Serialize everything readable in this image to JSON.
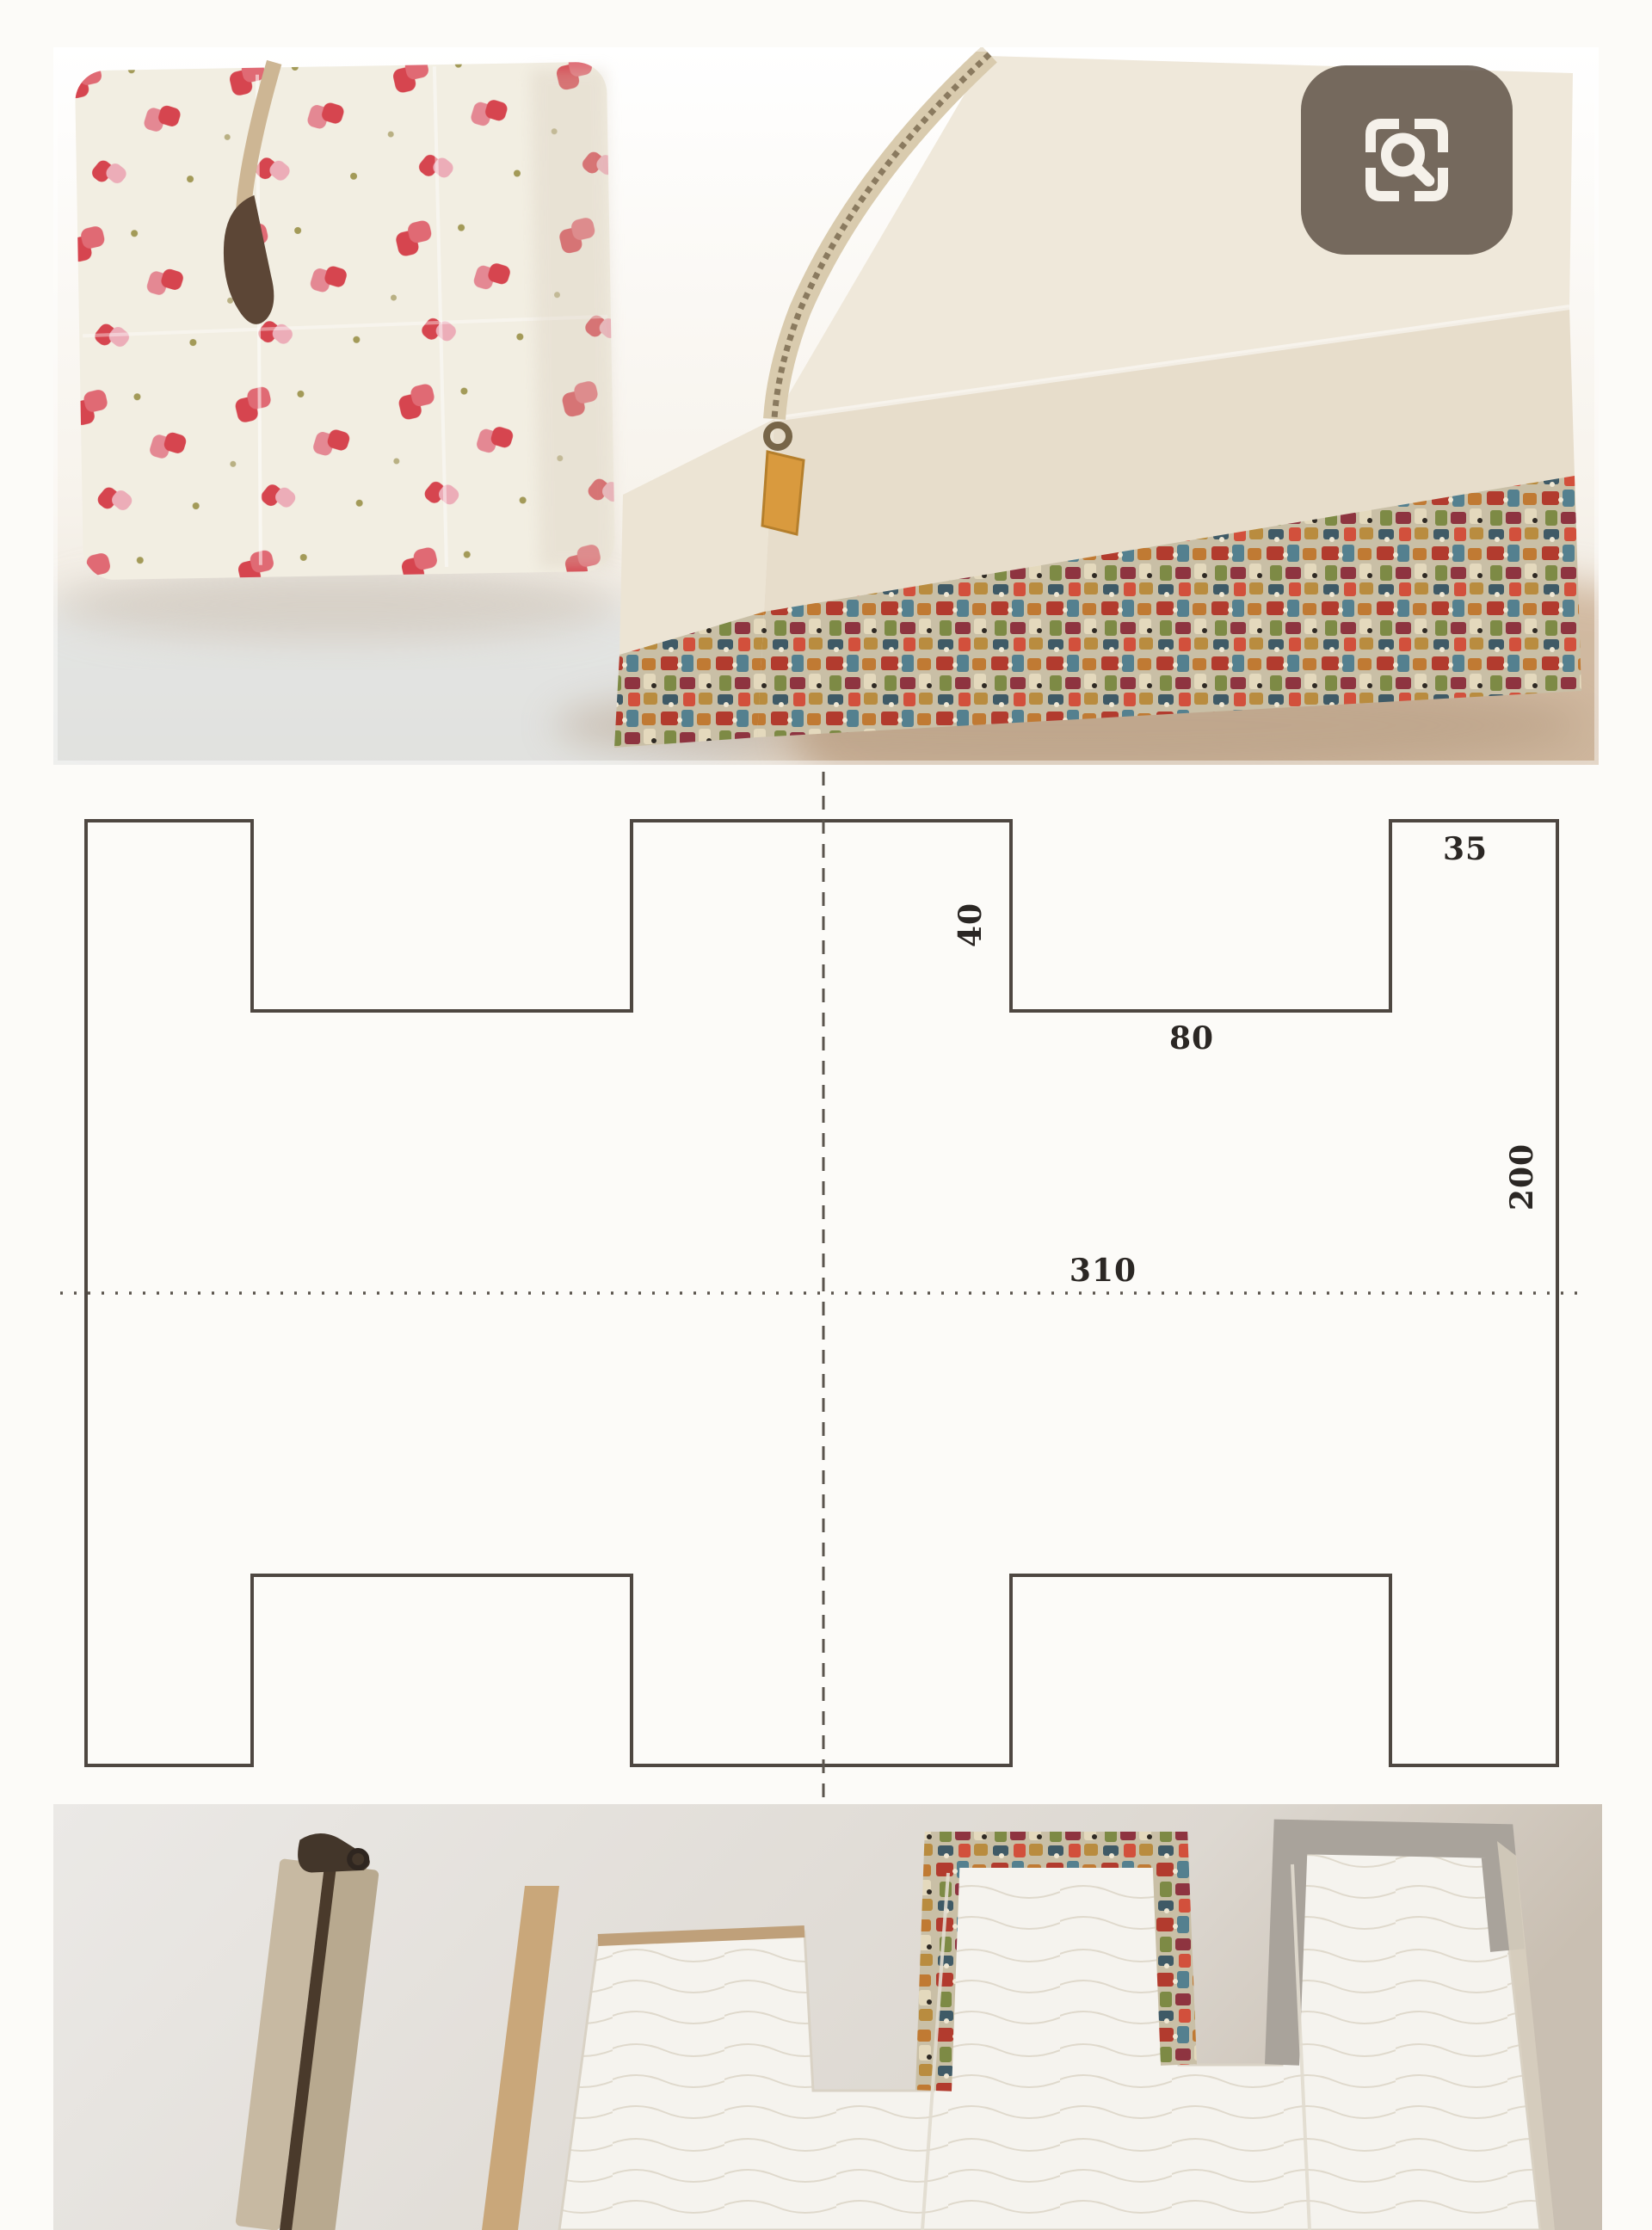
{
  "visual_search_button": {
    "icon": "magnifier-in-corner-brackets"
  },
  "pattern_diagram": {
    "type": "sewing-pattern",
    "unit": "mm",
    "labels": {
      "corner_tab_width": "35",
      "notch_depth": "40",
      "notch_width": "80",
      "total_width": "310",
      "total_height": "200"
    },
    "shape": "rectangle 310x200 with 80x40 notches cut into top and bottom edges leaving 35 corner tabs",
    "line_color": "#4e4741",
    "fold_lines": "dashed vertical center line, dotted horizontal center line"
  },
  "photos": {
    "top": "two boxy zipper pouches, cream linen with red floral print and multicolor print base",
    "bottom": "zipper, fabric strip and notched pattern-cut quilted fabric piece"
  },
  "colors": {
    "page_bg": "#fcfbf8",
    "cream_fabric": "#f2eee2",
    "print_red": "#b23b2e",
    "print_blue": "#54808f",
    "zipper_tape": "#c7b9a2",
    "lens_bg": "rgba(86,73,61,0.8)"
  }
}
